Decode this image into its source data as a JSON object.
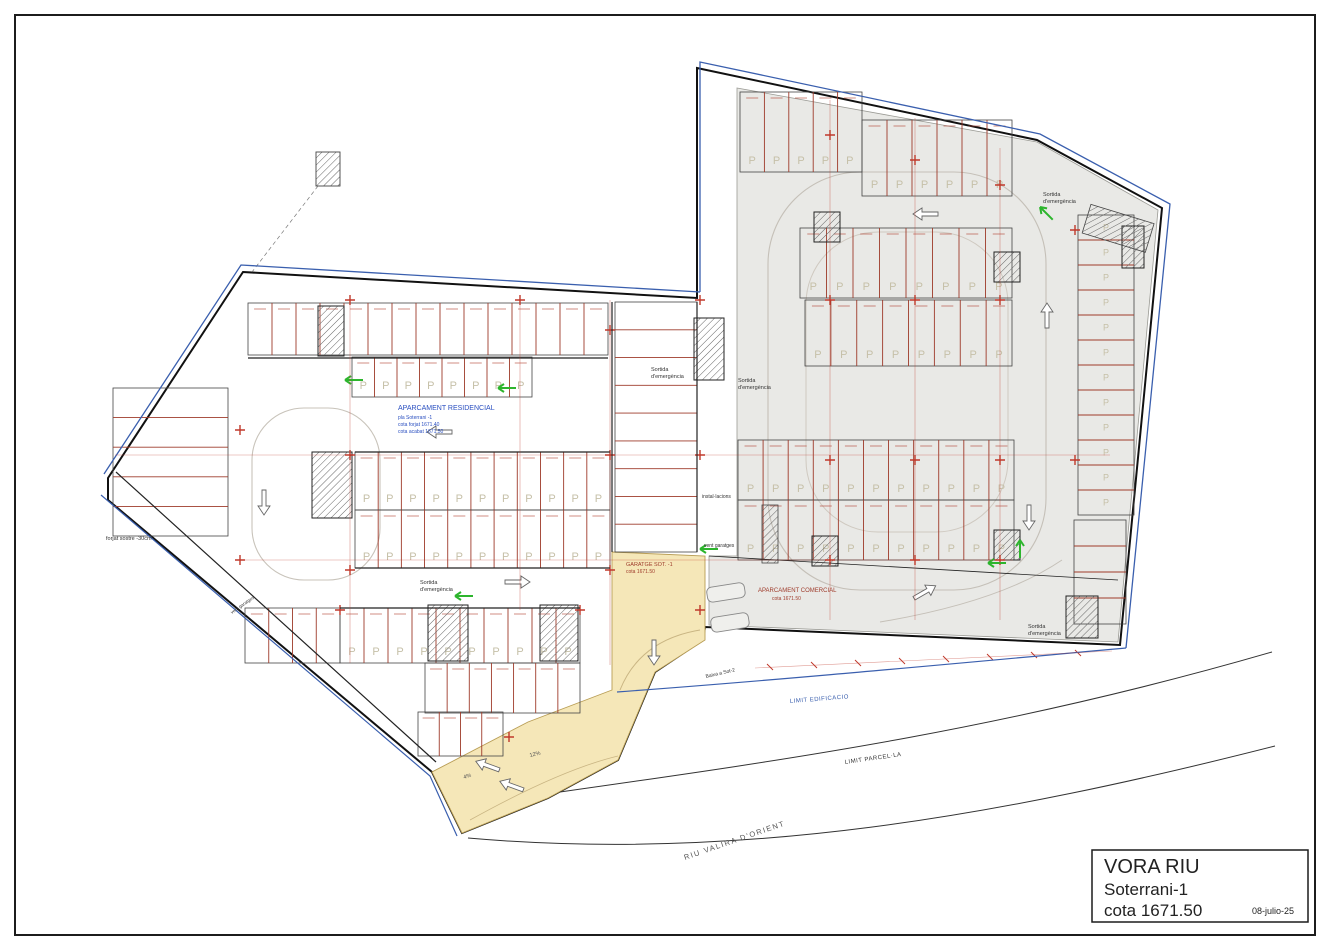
{
  "drawing": {
    "title_block": {
      "project": "VORA RIU",
      "level": "Soterrani-1",
      "elevation": "cota 1671.50",
      "date": "08-julio-25"
    },
    "zones": {
      "residential": {
        "title": "APARCAMENT RESIDENCIAL",
        "subtitle1": "pla Soterrani -1",
        "subtitle2": "cota forjat 1671.40",
        "subtitle3": "cota acabat 1671.50"
      },
      "commercial": {
        "title": "APARCAMENT COMERCIAL",
        "subtitle1": "cota 1671.50"
      },
      "garage": {
        "title": "GARATGE SOT. -1",
        "subtitle1": "cota 1671.50"
      }
    },
    "boundaries": {
      "building_limit": "LIMIT EDIFICACIO",
      "parcel_limit": "LIMIT PARCEL·LA",
      "river": "RIU VALIRA D'ORIENT"
    },
    "labels": {
      "exit_line1": "Sortida",
      "exit_line2": "d'emergència",
      "floor_note": "forjat sostre -30cm",
      "installations": "instal·lacions",
      "garage_vent": "vent garatges",
      "ramp_down": "Baixa a Sot-2",
      "slope_a": "4%",
      "slope_b": "12%",
      "stall_marker": "P"
    },
    "colors": {
      "stall_line_red": "#9e3a2a",
      "grid_red": "#c0392b",
      "boundary_blue": "#3a5fae",
      "note_blue": "#2a4fc0",
      "ramp_yellow": "#f5e7b8",
      "commercial_gray": "#e9e9e6",
      "exit_green": "#2db52d"
    }
  }
}
